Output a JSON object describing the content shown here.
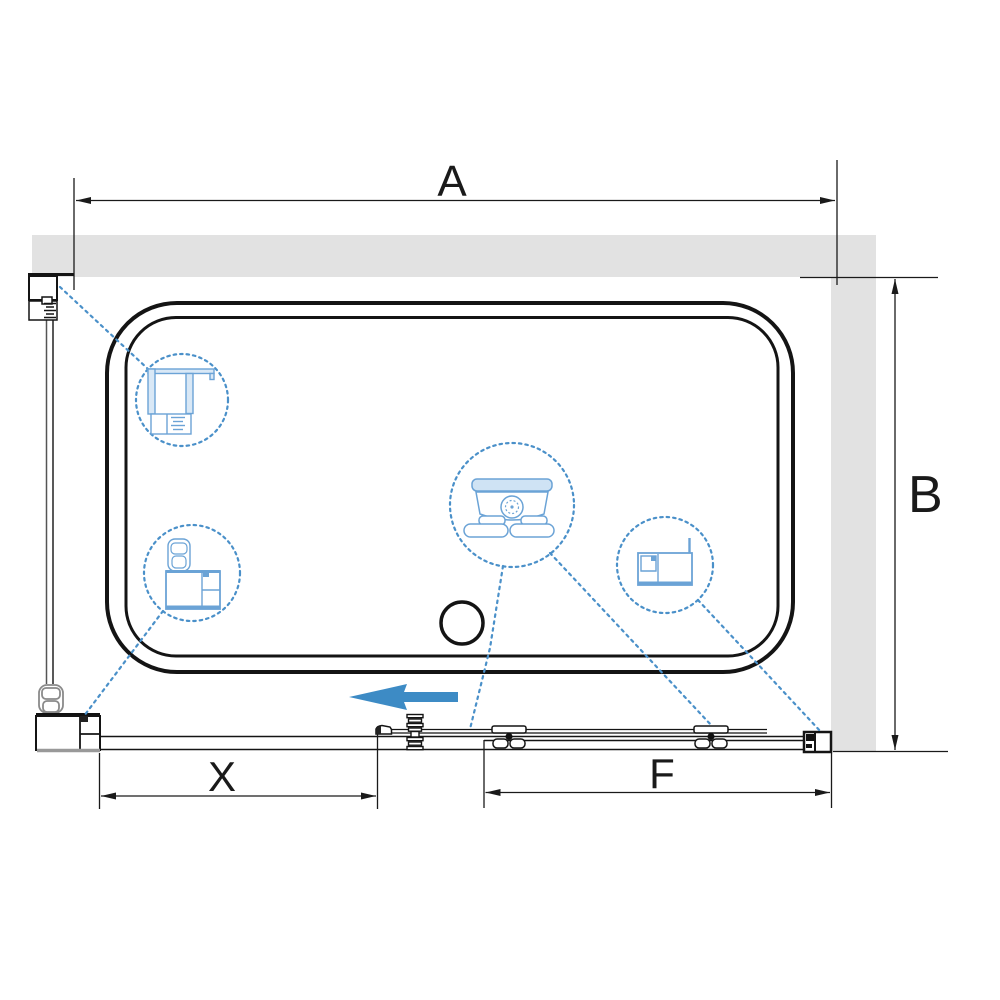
{
  "diagram": {
    "title": "shower-enclosure-top-view-technical-drawing",
    "dimensions": {
      "a": {
        "label": "A"
      },
      "b": {
        "label": "B"
      },
      "x": {
        "label": "X"
      },
      "f": {
        "label": "F"
      }
    },
    "callouts": [
      {
        "id": "wall-profile-detail"
      },
      {
        "id": "corner-profile-detail"
      },
      {
        "id": "roller-carriage-detail"
      },
      {
        "id": "bottom-rail-profile-detail"
      }
    ],
    "arrow": {
      "direction": "left"
    },
    "colors": {
      "wall_gray": "#e2e2e2",
      "line_black": "#1a1a1a",
      "hardware_gray": "#8a8a8a",
      "slide_arrow_blue": "#3d8bc5",
      "leader_blue": "#4a90c9",
      "detail_stroke_blue": "#6ba3d6",
      "detail_fill_blue": "#d9e8f6"
    }
  }
}
